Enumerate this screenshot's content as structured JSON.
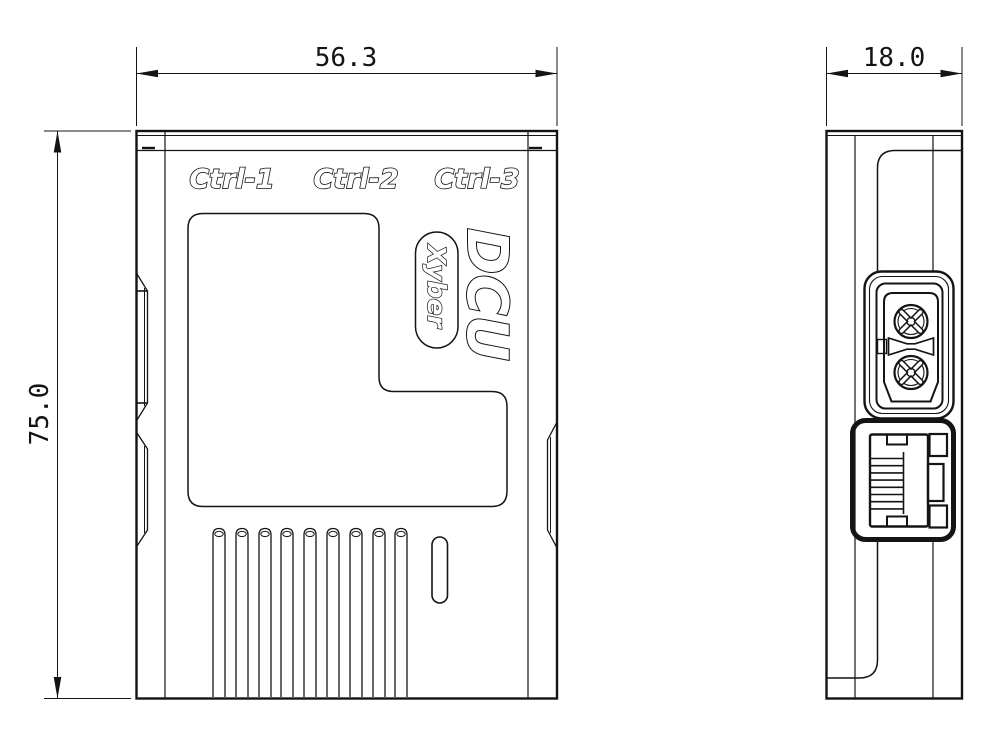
{
  "colors": {
    "line": "#141414",
    "background": "#ffffff",
    "text_fill": "#ffffff"
  },
  "front_view": {
    "port_labels": [
      "Ctrl-1",
      "Ctrl-2",
      "Ctrl-3"
    ],
    "product_name": "DCU",
    "brand_badge": "Xyber",
    "dim_width": "56.3",
    "dim_height": "75.0"
  },
  "side_view": {
    "dim_depth": "18.0"
  }
}
